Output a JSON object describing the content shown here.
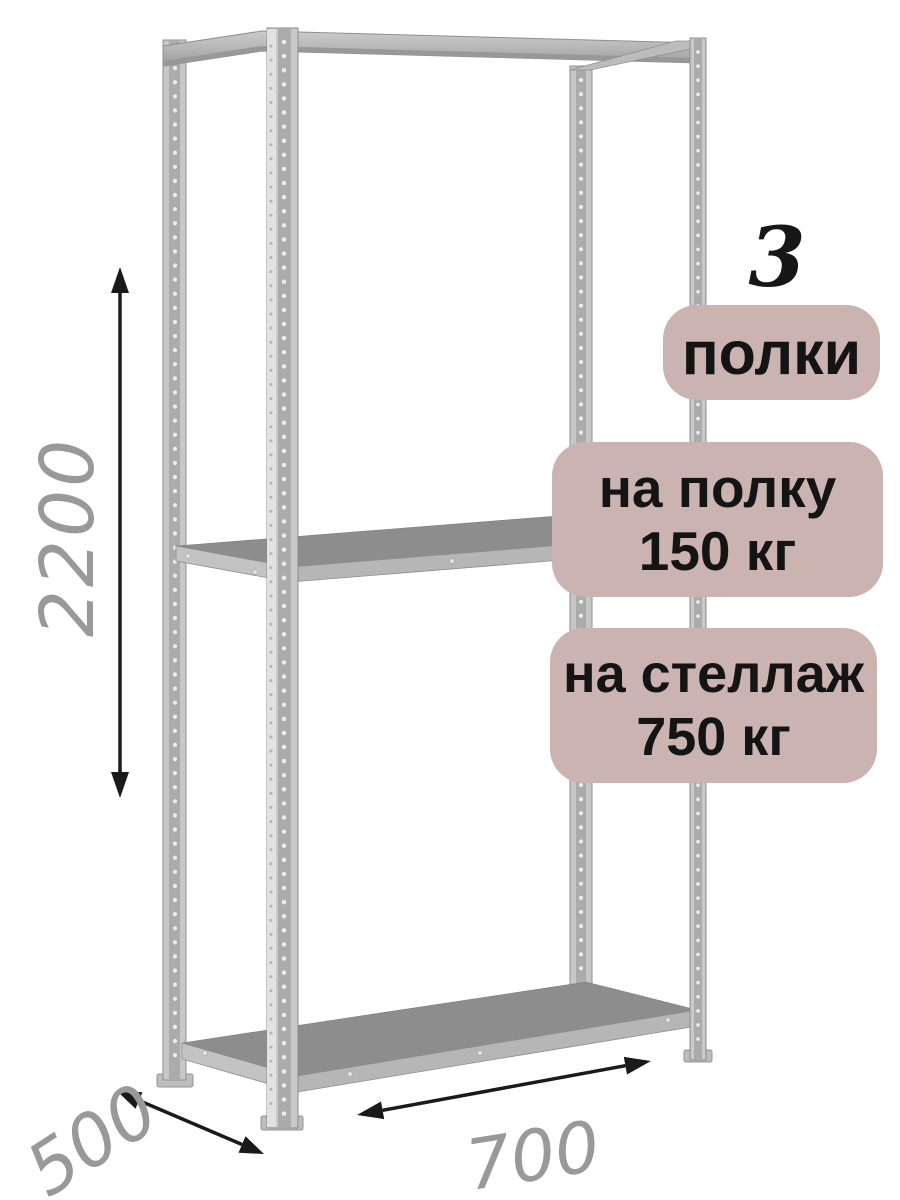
{
  "badges": {
    "shelf_count": {
      "value": "3",
      "label": "полки"
    },
    "per_shelf_capacity": {
      "line1": "на полку",
      "line2": "150 кг"
    },
    "per_rack_capacity": {
      "line1": "на стеллаж",
      "line2": "750 кг"
    },
    "background_color": "#cab3b1",
    "text_color": "#141414"
  },
  "dimensions": {
    "height": "2200",
    "depth": "500",
    "width": "700",
    "label_color": "#999999",
    "arrow_color": "#1a1a1a"
  },
  "illustration": {
    "subject": "metal-shelving-rack",
    "shelf_count": 3,
    "metal_light": "#c7c7c7",
    "metal_mid": "#ababab",
    "metal_dark": "#8d8d8d"
  }
}
